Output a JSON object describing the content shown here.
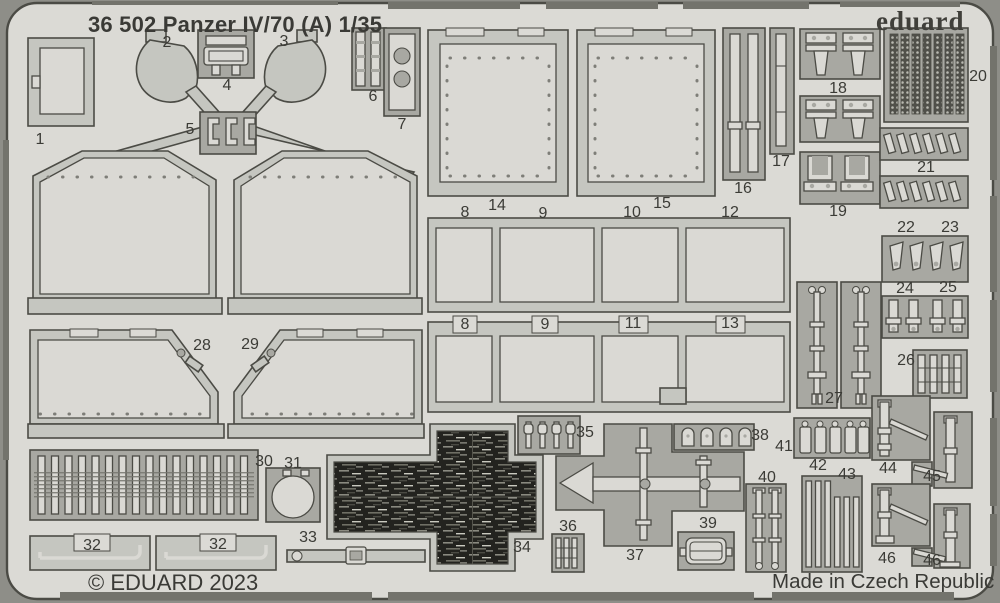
{
  "header": {
    "title": "36 502 Panzer IV/70 (A) 1/35",
    "brand": "eduard"
  },
  "footer": {
    "copyright": "© EDUARD 2023",
    "made_in": "Made in Czech Republic"
  },
  "sheet": {
    "kind": "photo-etched parts fret",
    "colors": {
      "background": "#8e8e88",
      "fret": "#dbdad5",
      "part": "#c5c6c0",
      "cutout": "#a8a8a2",
      "outline": "#4b4b45",
      "dark_texture_part": "#23231f",
      "text": "#3a3a36"
    }
  },
  "part_labels": [
    {
      "n": "1",
      "x": 40,
      "y": 140
    },
    {
      "n": "2",
      "x": 167,
      "y": 43
    },
    {
      "n": "3",
      "x": 284,
      "y": 42
    },
    {
      "n": "4",
      "x": 227,
      "y": 86
    },
    {
      "n": "5",
      "x": 190,
      "y": 130
    },
    {
      "n": "6",
      "x": 373,
      "y": 97
    },
    {
      "n": "7",
      "x": 402,
      "y": 125
    },
    {
      "n": "8",
      "x": 465,
      "y": 213
    },
    {
      "n": "14",
      "x": 497,
      "y": 206
    },
    {
      "n": "9",
      "x": 543,
      "y": 214
    },
    {
      "n": "10",
      "x": 632,
      "y": 213
    },
    {
      "n": "15",
      "x": 662,
      "y": 204
    },
    {
      "n": "12",
      "x": 730,
      "y": 213
    },
    {
      "n": "16",
      "x": 743,
      "y": 189
    },
    {
      "n": "17",
      "x": 781,
      "y": 162
    },
    {
      "n": "18",
      "x": 838,
      "y": 89
    },
    {
      "n": "19",
      "x": 838,
      "y": 212
    },
    {
      "n": "20",
      "x": 978,
      "y": 77
    },
    {
      "n": "21",
      "x": 926,
      "y": 168
    },
    {
      "n": "22",
      "x": 906,
      "y": 228
    },
    {
      "n": "23",
      "x": 950,
      "y": 228
    },
    {
      "n": "24",
      "x": 905,
      "y": 289
    },
    {
      "n": "25",
      "x": 948,
      "y": 288
    },
    {
      "n": "26",
      "x": 906,
      "y": 361
    },
    {
      "n": "27",
      "x": 834,
      "y": 399
    },
    {
      "n": "28",
      "x": 202,
      "y": 346
    },
    {
      "n": "29",
      "x": 250,
      "y": 345
    },
    {
      "n": "8",
      "x": 465,
      "y": 325
    },
    {
      "n": "9",
      "x": 545,
      "y": 325
    },
    {
      "n": "11",
      "x": 633,
      "y": 324
    },
    {
      "n": "13",
      "x": 730,
      "y": 324
    },
    {
      "n": "30",
      "x": 264,
      "y": 462
    },
    {
      "n": "31",
      "x": 293,
      "y": 464
    },
    {
      "n": "32",
      "x": 92,
      "y": 546
    },
    {
      "n": "32",
      "x": 218,
      "y": 545
    },
    {
      "n": "33",
      "x": 308,
      "y": 538
    },
    {
      "n": "34",
      "x": 522,
      "y": 548
    },
    {
      "n": "35",
      "x": 585,
      "y": 433
    },
    {
      "n": "36",
      "x": 568,
      "y": 527
    },
    {
      "n": "37",
      "x": 635,
      "y": 556
    },
    {
      "n": "38",
      "x": 760,
      "y": 436
    },
    {
      "n": "39",
      "x": 708,
      "y": 524
    },
    {
      "n": "40",
      "x": 767,
      "y": 478
    },
    {
      "n": "41",
      "x": 784,
      "y": 447
    },
    {
      "n": "42",
      "x": 818,
      "y": 466
    },
    {
      "n": "43",
      "x": 847,
      "y": 475
    },
    {
      "n": "44",
      "x": 888,
      "y": 469
    },
    {
      "n": "45",
      "x": 932,
      "y": 477
    },
    {
      "n": "46",
      "x": 887,
      "y": 559
    },
    {
      "n": "46",
      "x": 932,
      "y": 561
    }
  ]
}
